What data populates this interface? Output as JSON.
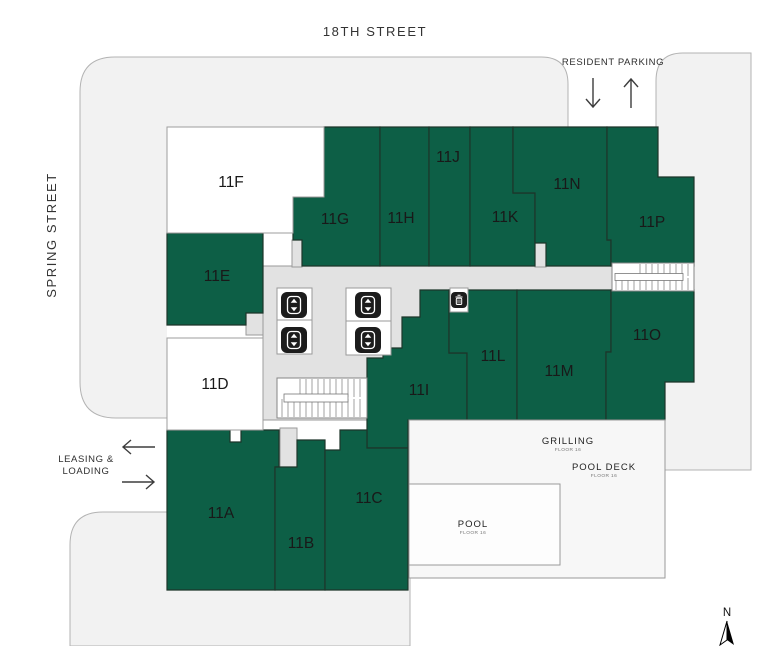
{
  "map": {
    "streets": {
      "top": "18TH STREET",
      "left": "SPRING STREET"
    },
    "parking": {
      "label": "RESIDENT PARKING"
    },
    "leasing": {
      "line1": "LEASING &",
      "line2": "LOADING"
    },
    "units": {
      "u11a": {
        "label": "11A"
      },
      "u11b": {
        "label": "11B"
      },
      "u11c": {
        "label": "11C"
      },
      "u11d": {
        "label": "11D"
      },
      "u11e": {
        "label": "11E"
      },
      "u11f": {
        "label": "11F"
      },
      "u11g": {
        "label": "11G"
      },
      "u11h": {
        "label": "11H"
      },
      "u11i": {
        "label": "11I"
      },
      "u11j": {
        "label": "11J"
      },
      "u11k": {
        "label": "11K"
      },
      "u11l": {
        "label": "11L"
      },
      "u11m": {
        "label": "11M"
      },
      "u11n": {
        "label": "11N"
      },
      "u11o": {
        "label": "11O"
      },
      "u11p": {
        "label": "11P"
      }
    },
    "amenities": {
      "grilling": {
        "label": "GRILLING",
        "caption": "FLOOR 16"
      },
      "pool_deck": {
        "label": "POOL DECK",
        "caption": "FLOOR 16"
      },
      "pool": {
        "label": "POOL",
        "caption": "FLOOR 16"
      }
    },
    "compass": {
      "north": "N"
    },
    "colors": {
      "unit_green": "#0d5f46",
      "street": "#f2f2f2",
      "corridor": "#e2e2e2",
      "unit_white": "#ffffff"
    }
  }
}
